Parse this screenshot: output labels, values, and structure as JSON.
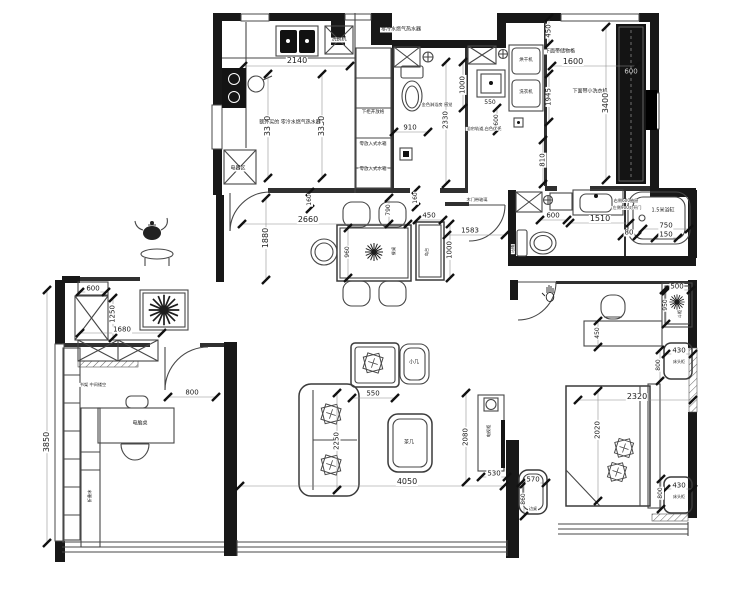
{
  "plan": {
    "type": "residential-apartment-floor-plan",
    "colors": {
      "wall": "#181818",
      "line": "#474747",
      "dim_text": "#1b1b1b",
      "paper": "#ffffff"
    },
    "labels": [
      {
        "t": "零冷水燃气热水器",
        "x": 401,
        "y": 30,
        "r": 0,
        "s": 5
      },
      {
        "t": "2140",
        "x": 297,
        "y": 61,
        "r": 0,
        "s": 8
      },
      {
        "t": "3330",
        "x": 268,
        "y": 126,
        "r": -90,
        "s": 8
      },
      {
        "t": "3330",
        "x": 322,
        "y": 126,
        "r": -90,
        "s": 8
      },
      {
        "t": "洗碗机",
        "x": 339,
        "y": 40,
        "r": 0,
        "s": 5
      },
      {
        "t": "额外买的 零冷水燃气热水器",
        "x": 290,
        "y": 123,
        "r": 0,
        "s": 5
      },
      {
        "t": "下柜开放格",
        "x": 373,
        "y": 113,
        "r": 0,
        "s": 4.5
      },
      {
        "t": "零放入式水箱",
        "x": 373,
        "y": 145,
        "r": 0,
        "s": 4.5
      },
      {
        "t": "零放入式水箱",
        "x": 373,
        "y": 170,
        "r": 0,
        "s": 4.5
      },
      {
        "t": "电器区",
        "x": 238,
        "y": 169,
        "r": 0,
        "s": 5
      },
      {
        "t": "910",
        "x": 410,
        "y": 128,
        "r": 0,
        "s": 7
      },
      {
        "t": "2330",
        "x": 446,
        "y": 120,
        "r": -90,
        "s": 7
      },
      {
        "t": "1000",
        "x": 463,
        "y": 85,
        "r": -90,
        "s": 7
      },
      {
        "t": "金色淋浴房 感觉",
        "x": 437,
        "y": 105,
        "r": 0,
        "s": 4.2
      },
      {
        "t": "550",
        "x": 490,
        "y": 103,
        "r": 0,
        "s": 6
      },
      {
        "t": "600",
        "x": 497,
        "y": 120,
        "r": -90,
        "s": 6
      },
      {
        "t": "浴帘轨道,白色优先",
        "x": 484,
        "y": 129,
        "r": 0,
        "s": 4.2
      },
      {
        "t": "烘干机",
        "x": 526,
        "y": 61,
        "r": 0,
        "s": 4.5
      },
      {
        "t": "洗衣机",
        "x": 526,
        "y": 93,
        "r": 0,
        "s": 4.5
      },
      {
        "t": "下面带储物格",
        "x": 560,
        "y": 52,
        "r": 0,
        "s": 5
      },
      {
        "t": "1600",
        "x": 573,
        "y": 62,
        "r": 0,
        "s": 8
      },
      {
        "t": "1945",
        "x": 549,
        "y": 97,
        "r": -90,
        "s": 7
      },
      {
        "t": "下面带小洗衣机",
        "x": 590,
        "y": 92,
        "r": 0,
        "s": 5
      },
      {
        "t": "450",
        "x": 549,
        "y": 31,
        "r": -90,
        "s": 7
      },
      {
        "t": "810",
        "x": 543,
        "y": 160,
        "r": -90,
        "s": 7
      },
      {
        "t": "3400",
        "x": 606,
        "y": 103,
        "r": -90,
        "s": 8
      },
      {
        "t": "600",
        "x": 631,
        "y": 72,
        "r": 0,
        "s": 7,
        "c": "#cfcfcf",
        "bg": "none"
      },
      {
        "t": "600",
        "x": 553,
        "y": 216,
        "r": 0,
        "s": 7
      },
      {
        "t": "1510",
        "x": 600,
        "y": 219,
        "r": 0,
        "s": 8
      },
      {
        "t": "右侧600抽屉",
        "x": 626,
        "y": 201,
        "r": 0,
        "s": 4.2
      },
      {
        "t": "左侧900对开门",
        "x": 627,
        "y": 208,
        "r": 0,
        "s": 4.2
      },
      {
        "t": "1.5米浴缸",
        "x": 663,
        "y": 211,
        "r": 0,
        "s": 5
      },
      {
        "t": "750",
        "x": 666,
        "y": 226,
        "r": 0,
        "s": 7
      },
      {
        "t": "80",
        "x": 629,
        "y": 233,
        "r": 0,
        "s": 7
      },
      {
        "t": "150",
        "x": 666,
        "y": 235,
        "r": 0,
        "s": 7
      },
      {
        "t": "马桶",
        "x": 513,
        "y": 249,
        "r": -90,
        "s": 4.2
      },
      {
        "t": "2660",
        "x": 308,
        "y": 220,
        "r": 0,
        "s": 8
      },
      {
        "t": "1880",
        "x": 266,
        "y": 238,
        "r": -90,
        "s": 8
      },
      {
        "t": "160",
        "x": 310,
        "y": 200,
        "r": -90,
        "s": 6
      },
      {
        "t": "790",
        "x": 389,
        "y": 210,
        "r": -90,
        "s": 6
      },
      {
        "t": "160",
        "x": 416,
        "y": 198,
        "r": -90,
        "s": 6
      },
      {
        "t": "960",
        "x": 348,
        "y": 252,
        "r": -90,
        "s": 6
      },
      {
        "t": "餐桌",
        "x": 394,
        "y": 251,
        "r": -90,
        "s": 4.2
      },
      {
        "t": "450",
        "x": 429,
        "y": 216,
        "r": 0,
        "s": 7
      },
      {
        "t": "1000",
        "x": 450,
        "y": 250,
        "r": -90,
        "s": 7
      },
      {
        "t": "岛台",
        "x": 427,
        "y": 252,
        "r": -90,
        "s": 4.2
      },
      {
        "t": "1583",
        "x": 470,
        "y": 231,
        "r": 0,
        "s": 7
      },
      {
        "t": "木门带玻璃",
        "x": 477,
        "y": 200,
        "r": 0,
        "s": 4.2
      },
      {
        "t": "600",
        "x": 93,
        "y": 289,
        "r": 0,
        "s": 7
      },
      {
        "t": "1250",
        "x": 113,
        "y": 314,
        "r": -90,
        "s": 7
      },
      {
        "t": "1680",
        "x": 122,
        "y": 330,
        "r": 0,
        "s": 7
      },
      {
        "t": "书架 中间镂空",
        "x": 93,
        "y": 385,
        "r": 0,
        "s": 4.2
      },
      {
        "t": "800",
        "x": 192,
        "y": 393,
        "r": 0,
        "s": 7
      },
      {
        "t": "电脑桌",
        "x": 140,
        "y": 424,
        "r": 0,
        "s": 5
      },
      {
        "t": "3850",
        "x": 47,
        "y": 442,
        "r": -90,
        "s": 8
      },
      {
        "t": "折叠床",
        "x": 90,
        "y": 496,
        "r": -90,
        "s": 4.2
      },
      {
        "t": "小几",
        "x": 414,
        "y": 363,
        "r": 0,
        "s": 5
      },
      {
        "t": "550",
        "x": 373,
        "y": 394,
        "r": 0,
        "s": 7
      },
      {
        "t": "2250",
        "x": 337,
        "y": 441,
        "r": -90,
        "s": 7
      },
      {
        "t": "茶几",
        "x": 409,
        "y": 443,
        "r": 0,
        "s": 5
      },
      {
        "t": "4050",
        "x": 407,
        "y": 482,
        "r": 0,
        "s": 8
      },
      {
        "t": "2080",
        "x": 466,
        "y": 437,
        "r": -90,
        "s": 7
      },
      {
        "t": "电视柜",
        "x": 489,
        "y": 431,
        "r": -90,
        "s": 4.2
      },
      {
        "t": "530",
        "x": 494,
        "y": 474,
        "r": 0,
        "s": 7
      },
      {
        "t": "450",
        "x": 598,
        "y": 333,
        "r": -90,
        "s": 6
      },
      {
        "t": "500",
        "x": 677,
        "y": 287,
        "r": 0,
        "s": 7
      },
      {
        "t": "950",
        "x": 666,
        "y": 305,
        "r": -90,
        "s": 6
      },
      {
        "t": "斗柜",
        "x": 680,
        "y": 314,
        "r": -90,
        "s": 4.2
      },
      {
        "t": "430",
        "x": 679,
        "y": 351,
        "r": 0,
        "s": 7
      },
      {
        "t": "床头柜",
        "x": 679,
        "y": 362,
        "r": 0,
        "s": 4
      },
      {
        "t": "800",
        "x": 659,
        "y": 365,
        "r": -90,
        "s": 6
      },
      {
        "t": "2320",
        "x": 637,
        "y": 397,
        "r": 0,
        "s": 8
      },
      {
        "t": "2020",
        "x": 598,
        "y": 430,
        "r": -90,
        "s": 7
      },
      {
        "t": "430",
        "x": 679,
        "y": 486,
        "r": 0,
        "s": 7
      },
      {
        "t": "床头柜",
        "x": 679,
        "y": 497,
        "r": 0,
        "s": 4
      },
      {
        "t": "800",
        "x": 661,
        "y": 493,
        "r": -90,
        "s": 6
      },
      {
        "t": "570",
        "x": 533,
        "y": 480,
        "r": 0,
        "s": 7
      },
      {
        "t": "860",
        "x": 524,
        "y": 499,
        "r": -90,
        "s": 6
      },
      {
        "t": "边桌",
        "x": 533,
        "y": 509,
        "r": 0,
        "s": 4
      }
    ]
  }
}
